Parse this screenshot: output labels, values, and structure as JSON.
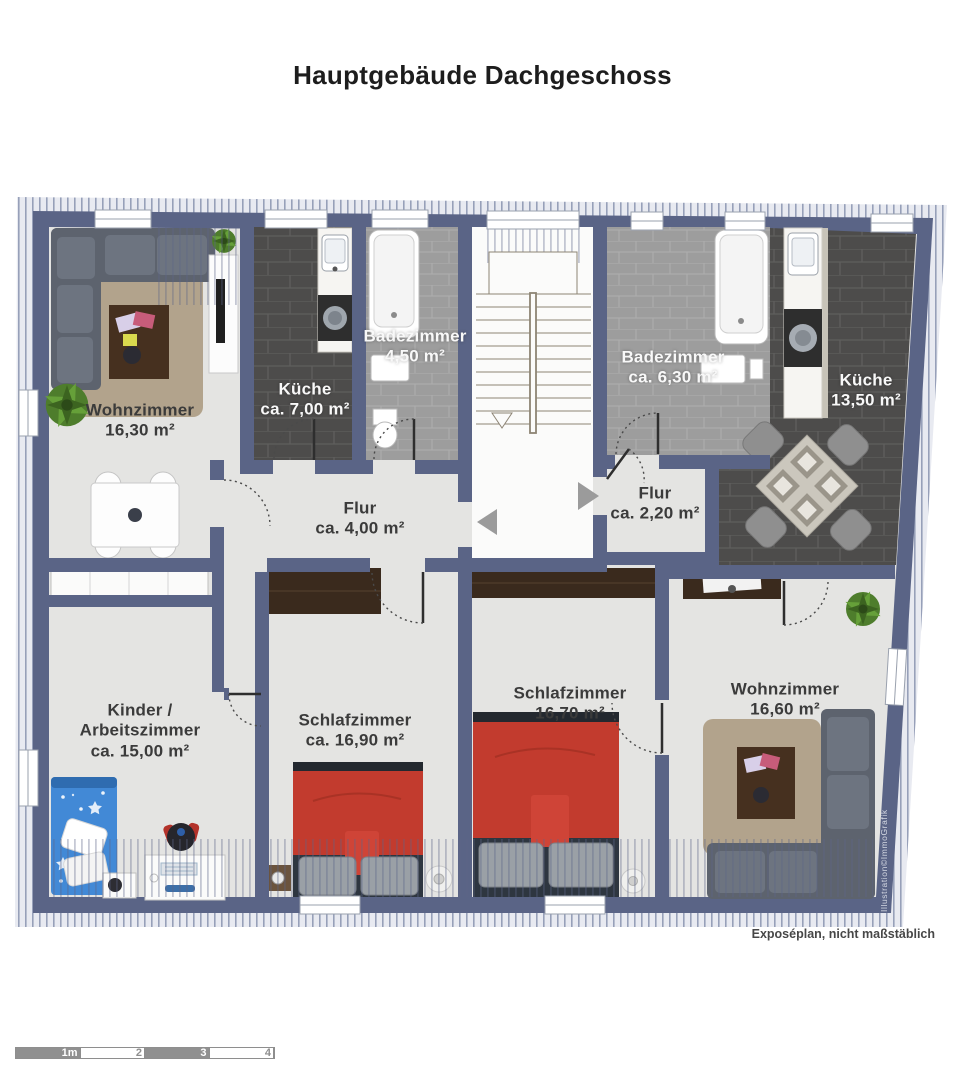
{
  "title": "Hauptgebäude Dachgeschoss",
  "footer_note": "Exposéplan, nicht maßstäblich",
  "watermark": "Illustration©ImmoGrafik",
  "rooms": [
    {
      "id": "wohnzimmer-links",
      "name": "Wohnzimmer",
      "area": "16,30 m²"
    },
    {
      "id": "kueche-links",
      "name": "Küche",
      "area": "ca. 7,00 m²"
    },
    {
      "id": "badezimmer-links",
      "name": "Badezimmer",
      "area": "4,50 m²"
    },
    {
      "id": "badezimmer-rechts",
      "name": "Badezimmer",
      "area": "ca. 6,30 m²"
    },
    {
      "id": "kueche-rechts",
      "name": "Küche",
      "area": "13,50 m²"
    },
    {
      "id": "flur-links",
      "name": "Flur",
      "area": "ca. 4,00 m²"
    },
    {
      "id": "flur-rechts",
      "name": "Flur",
      "area": "ca. 2,20 m²"
    },
    {
      "id": "kinder-arbeitszimmer",
      "name": "Kinder /",
      "name2": "Arbeitszimmer",
      "area": "ca. 15,00 m²"
    },
    {
      "id": "schlafzimmer-links",
      "name": "Schlafzimmer",
      "area": "ca. 16,90 m²"
    },
    {
      "id": "schlafzimmer-mitte",
      "name": "Schlafzimmer",
      "area": "16,70 m²"
    },
    {
      "id": "wohnzimmer-rechts",
      "name": "Wohnzimmer",
      "area": "16,60 m²"
    }
  ],
  "scale_bar": {
    "labels": [
      "1m",
      "2",
      "3",
      "4"
    ]
  },
  "stairs": {
    "direction": "down"
  },
  "colors": {
    "wall": "#5a6486",
    "floor_light": "#e4e4e2",
    "tile_dark": "#4d4c4b",
    "tile_gray": "#9d9d9d",
    "bed_red": "#c23b2e",
    "bed_blue": "#4289d6",
    "furniture_brown": "#3a2a1d",
    "rug": "#b2a38c"
  }
}
